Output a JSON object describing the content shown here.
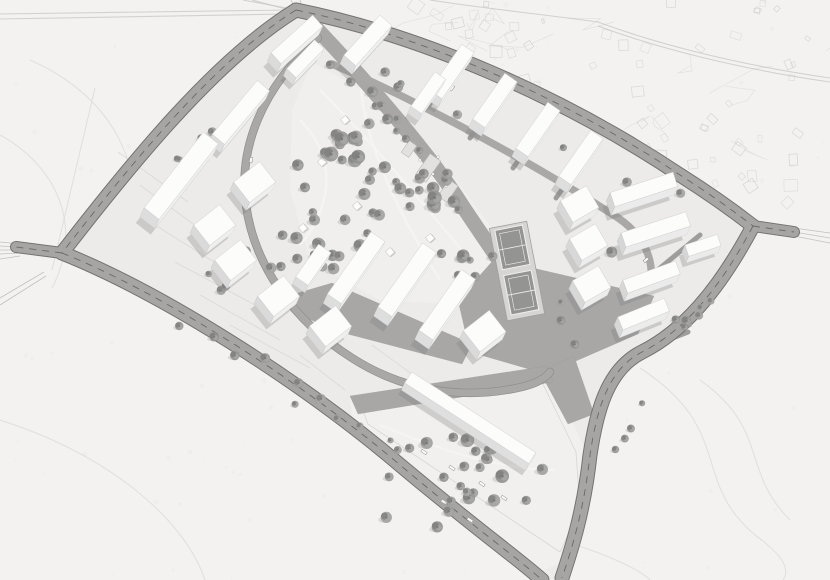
{
  "meta": {
    "description": "aerial-masterplan-rendering",
    "canvas_w": 830,
    "canvas_h": 580
  },
  "scene": {
    "palette": {
      "background": "#f3f2f1",
      "site_ground": "#ecebe9",
      "park_ground": "#f0efed",
      "garden_ground": "#f1f0ee",
      "road_fill": "#a6a5a4",
      "road_edge": "#747372",
      "road_dash": "#5e5e5d",
      "inner_road": "#a9a8a7",
      "lane": "#9e9d9c",
      "plaza": "#a8a7a6",
      "court_pad": "#d6d5d4",
      "court_surface": "#949493",
      "court_lines": "#efefee",
      "building_top": "#fcfcfb",
      "building_stroke": "#cfcfce",
      "shadow": "#7e7e7d",
      "tree_main": "#8f8f8e",
      "tree_dark": "#7c7c7b",
      "tree_light": "#a9a9a8",
      "context_line": "#c9c8c7",
      "contour_line": "#dedddc",
      "plot_line": "#d8d7d6",
      "park_path": "#f5f4f3",
      "stub_line": "#b4b4b3"
    },
    "site_outline": "M 296 10 C 420 35 560 95 680 175 C 710 194 735 212 753 226 C 718 292 682 332 642 352 C 606 370 596 415 590 455 C 584 510 572 548 562 578 L 540 580 C 520 552 480 525 400 465 C 300 380 160 292 62 253 C 115 160 215 60 296 10 Z",
    "park_poly": "312,62 380,100 450,172 502,242 505,298 462,305 380,300 310,262 290,190 292,110",
    "garden_poly": "350,400 547,368 586,452 589,508 566,560 540,572 352,418",
    "garden_outline": "M 362 408 L 540 378 L 576 452 L 580 508 L 560 552 L 368 424 Z",
    "plazas": [
      "497,256 524,266 654,296 638,334 546,374 470,352 458,300",
      "298,293 332,283 472,344 462,364 340,332 292,312",
      "540,372 574,356 594,414 568,424",
      "350,396 547,366 553,382 358,414"
    ],
    "spine": {
      "d": "M 316 28 C 356 70 420 142 456 196 C 474 224 490 246 500 262",
      "w": 15
    },
    "inner_roads": [
      {
        "d": "M 332 64 C 430 106 540 168 612 214 C 642 232 656 258 650 288",
        "w": 7.5
      }
    ],
    "inner_loop": {
      "d": "M 318 38 C 262 88 238 148 246 205 C 254 264 292 320 352 358 C 402 390 456 398 506 390 C 532 386 544 380 550 372",
      "w": 7
    },
    "roads": [
      {
        "d": "M 296 10 C 215 60 130 165 62 253",
        "w": 13
      },
      {
        "d": "M 296 10 C 420 35 560 95 680 175 C 710 194 735 212 753 226",
        "w": 13
      },
      {
        "d": "M 753 226 C 718 292 682 332 642 352 C 606 370 596 415 590 455 C 584 510 572 548 562 578",
        "w": 13
      },
      {
        "d": "M 62 253 C 160 292 300 380 400 465 C 480 532 520 560 542 580",
        "w": 13
      },
      {
        "d": "M 62 253 L 16 247",
        "w": 10
      },
      {
        "d": "M 753 226 L 794 232",
        "w": 10
      }
    ],
    "lanes": [
      "M 455 68 L 427 108",
      "M 498 98 L 470 138",
      "M 541 128 L 513 168",
      "M 584 158 L 556 198",
      "M 700 235 L 648 278",
      "M 688 332 L 636 352"
    ],
    "plot_lines": [
      "M 140 185 L 215 240",
      "M 155 225 L 235 275",
      "M 175 262 L 255 305",
      "M 200 295 L 280 340",
      "M 230 325 L 310 368",
      "M 118 152 L 188 202",
      "M 372 345 L 420 380",
      "M 300 355 L 345 390"
    ],
    "park_paths": [
      "M 300 120 C 340 160 330 210 300 245",
      "M 320 90 C 370 140 420 200 470 260",
      "M 360 70 C 360 130 390 200 440 280",
      "M 380 425 C 440 450 500 470 555 470"
    ],
    "contours": [
      "M 30 60 C 110 95 150 165 128 245",
      "M 0 135 C 55 165 85 225 52 288",
      "M 95 88 L 52 270",
      "M 0 420 C 110 455 185 520 205 580",
      "M 640 368 C 735 430 690 480 755 535 C 785 557 790 570 783 580",
      "M 700 380 C 770 430 740 470 790 520",
      "M 560 540 C 610 555 640 570 650 580"
    ],
    "context_roads": [
      "M 430 0 C 480 8 540 14 598 22",
      "M 598 22 C 660 45 740 65 830 78",
      "M 598 26 C 660 49 740 69 830 82",
      "M 0 14 L 290 10",
      "M 0 19 L 288 14",
      "M 243 0 L 292 9",
      "M 252 0 L 297 12"
    ],
    "stub_lines": [
      "M 0 242 L 20 244",
      "M 0 246 L 20 247",
      "M 0 250 L 20 250",
      "M 0 254 L 20 253",
      "M 0 259 L 20 256",
      "M 794 228 L 830 233",
      "M 794 232 L 830 238",
      "M 794 236 L 830 243",
      "M 291 0 L 296 10",
      "M 300 0 L 303 10",
      "M 0 298 L 44 272",
      "M 0 305 L 46 276"
    ],
    "courts": {
      "cx": 517,
      "cy": 271,
      "rot": -11,
      "w": 38,
      "h": 94,
      "fields": [
        {
          "y": -44,
          "h": 40
        },
        {
          "y": 2,
          "h": 40
        }
      ]
    },
    "playground": {
      "pads": [
        [
          428,
          168,
          26,
          13
        ],
        [
          448,
          191,
          20,
          11
        ],
        [
          409,
          149,
          14,
          9
        ]
      ],
      "pad_rot": -55,
      "dots": [
        [
          420,
          160
        ],
        [
          433,
          174
        ],
        [
          446,
          186
        ],
        [
          416,
          181
        ],
        [
          438,
          157
        ]
      ]
    },
    "park_structures": [
      [
        322,
        162
      ],
      [
        303,
        228
      ],
      [
        357,
        206
      ],
      [
        390,
        252
      ],
      [
        345,
        120
      ],
      [
        430,
        238
      ]
    ],
    "benches": [
      [
        424,
        452
      ],
      [
        452,
        468
      ],
      [
        482,
        484
      ],
      [
        444,
        502
      ],
      [
        504,
        498
      ],
      [
        470,
        520
      ]
    ],
    "bench_rot": 33,
    "cars": [
      [
        452,
        88,
        -55
      ],
      [
        486,
        120,
        -55
      ],
      [
        530,
        150,
        -55
      ],
      [
        573,
        180,
        -55
      ],
      [
        646,
        260,
        -40
      ],
      [
        251,
        160,
        -80
      ]
    ],
    "buildings_format": "cx,cy,length,depth,rot_deg,extrude_height",
    "buildings": [
      [
        293,
        48,
        56,
        15,
        -42,
        13
      ],
      [
        364,
        49,
        54,
        16,
        -48,
        13
      ],
      [
        448,
        80,
        56,
        15,
        -55,
        13
      ],
      [
        491,
        109,
        56,
        15,
        -55,
        13
      ],
      [
        534,
        138,
        56,
        15,
        -55,
        13
      ],
      [
        577,
        166,
        56,
        15,
        -55,
        13
      ],
      [
        302,
        66,
        40,
        13,
        -46,
        11
      ],
      [
        425,
        100,
        42,
        13,
        -55,
        11
      ],
      [
        640,
        198,
        66,
        15,
        -18,
        13
      ],
      [
        652,
        238,
        68,
        15,
        -18,
        13
      ],
      [
        648,
        285,
        56,
        14,
        -20,
        12
      ],
      [
        700,
        252,
        34,
        12,
        -18,
        10
      ],
      [
        576,
        212,
        30,
        25,
        -30,
        12
      ],
      [
        585,
        250,
        30,
        25,
        -30,
        12
      ],
      [
        588,
        292,
        30,
        25,
        -30,
        12
      ],
      [
        640,
        322,
        50,
        14,
        -22,
        12
      ],
      [
        237,
        121,
        70,
        16,
        -50,
        13
      ],
      [
        177,
        185,
        96,
        19,
        -52,
        14
      ],
      [
        211,
        233,
        33,
        26,
        -38,
        12
      ],
      [
        251,
        190,
        33,
        26,
        -38,
        12
      ],
      [
        232,
        268,
        33,
        26,
        -38,
        12
      ],
      [
        275,
        304,
        33,
        26,
        -38,
        12
      ],
      [
        327,
        334,
        33,
        26,
        -38,
        12
      ],
      [
        310,
        272,
        40,
        15,
        -55,
        11
      ],
      [
        481,
        339,
        33,
        27,
        -38,
        12
      ],
      [
        352,
        277,
        76,
        17,
        -55,
        14
      ],
      [
        403,
        289,
        78,
        17,
        -55,
        14
      ],
      [
        443,
        314,
        74,
        17,
        -55,
        14
      ],
      [
        467,
        425,
        148,
        13,
        33,
        11
      ]
    ],
    "tree_clusters": [
      {
        "t": "e",
        "cx": 352,
        "cy": 150,
        "rx": 68,
        "ry": 52,
        "n": 20,
        "r0": 4,
        "r1": 7.5,
        "seed": 11
      },
      {
        "t": "e",
        "cx": 428,
        "cy": 208,
        "rx": 58,
        "ry": 52,
        "n": 17,
        "r0": 4,
        "r1": 7.5,
        "seed": 22
      },
      {
        "t": "e",
        "cx": 330,
        "cy": 235,
        "rx": 52,
        "ry": 42,
        "n": 12,
        "r0": 4,
        "r1": 7,
        "seed": 33
      },
      {
        "t": "e",
        "cx": 462,
        "cy": 262,
        "rx": 38,
        "ry": 36,
        "n": 8,
        "r0": 3.5,
        "r1": 6.5,
        "seed": 44
      },
      {
        "t": "l",
        "x1": 322,
        "y1": 56,
        "x2": 452,
        "y2": 188,
        "n": 9,
        "j": 10,
        "r0": 3.5,
        "r1": 6,
        "seed": 55
      },
      {
        "t": "l",
        "x1": 340,
        "y1": 54,
        "x2": 726,
        "y2": 220,
        "n": 9,
        "j": 11,
        "r0": 3,
        "r1": 5.5,
        "seed": 66
      },
      {
        "t": "l",
        "x1": 602,
        "y1": 252,
        "x2": 692,
        "y2": 328,
        "n": 7,
        "j": 16,
        "r0": 3.5,
        "r1": 6,
        "seed": 77
      },
      {
        "t": "l",
        "x1": 702,
        "y1": 298,
        "x2": 606,
        "y2": 468,
        "n": 8,
        "j": 9,
        "r0": 3,
        "r1": 5.5,
        "seed": 88
      },
      {
        "t": "l",
        "x1": 112,
        "y1": 278,
        "x2": 476,
        "y2": 500,
        "n": 12,
        "j": 12,
        "r0": 3,
        "r1": 5.5,
        "seed": 99
      },
      {
        "t": "e",
        "cx": 258,
        "cy": 272,
        "rx": 78,
        "ry": 66,
        "n": 10,
        "r0": 3,
        "r1": 5.5,
        "seed": 111
      },
      {
        "t": "e",
        "cx": 458,
        "cy": 482,
        "rx": 88,
        "ry": 58,
        "n": 17,
        "r0": 4,
        "r1": 7,
        "seed": 122
      },
      {
        "t": "l",
        "x1": 388,
        "y1": 428,
        "x2": 545,
        "y2": 472,
        "n": 7,
        "j": 10,
        "r0": 3.5,
        "r1": 6,
        "seed": 133
      },
      {
        "t": "l",
        "x1": 560,
        "y1": 300,
        "x2": 578,
        "y2": 360,
        "n": 3,
        "j": 8,
        "r0": 3,
        "r1": 5,
        "seed": 144
      },
      {
        "t": "e",
        "cx": 200,
        "cy": 160,
        "rx": 40,
        "ry": 40,
        "n": 5,
        "r0": 3,
        "r1": 5,
        "seed": 155
      }
    ],
    "cadastral": {
      "seed": 7,
      "rect_count": 58,
      "line_count": 14,
      "x_min": 415,
      "x_max": 828
    },
    "speckle": {
      "seed": 5,
      "count": 110
    }
  }
}
